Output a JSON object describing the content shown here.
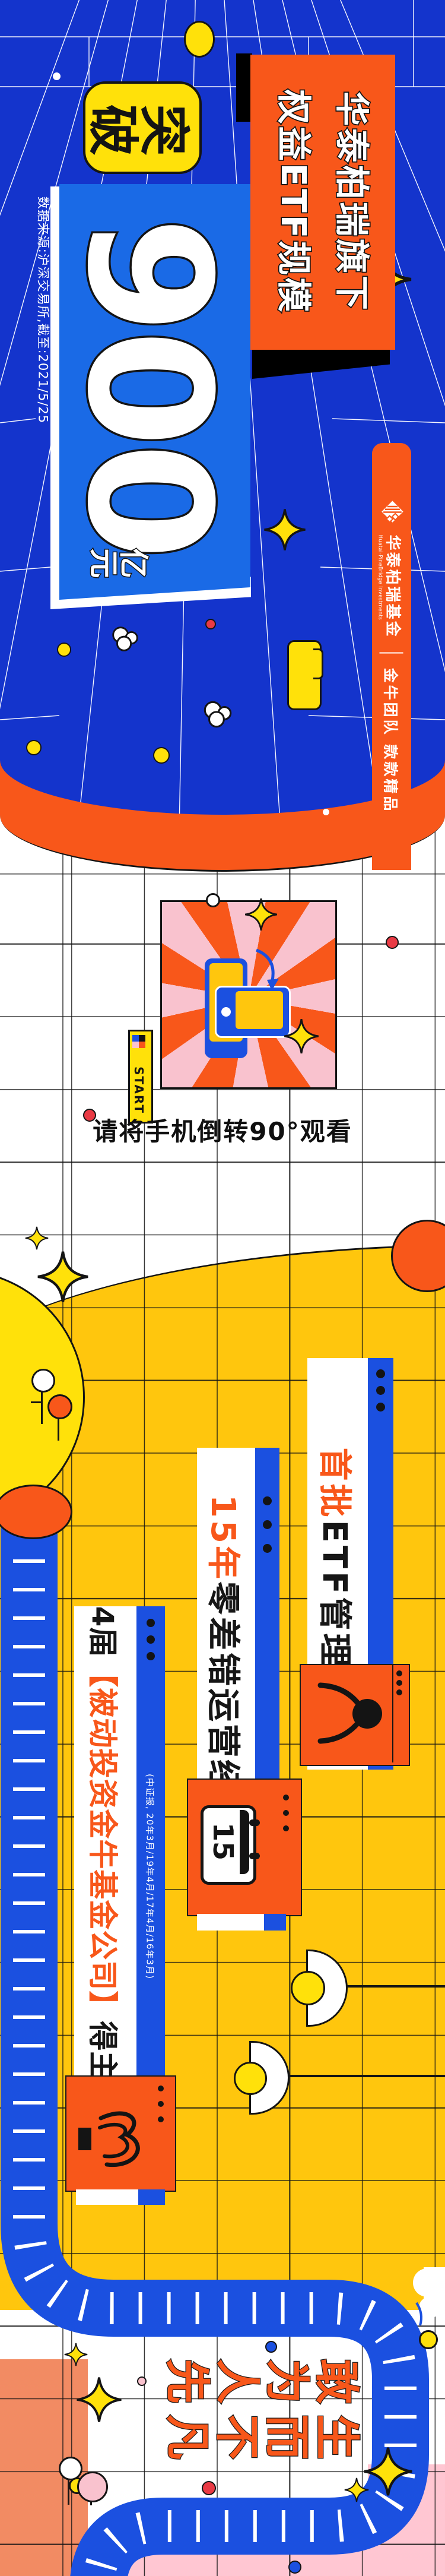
{
  "palette": {
    "bg_blue": "#1434CC",
    "panel_blue": "#1A6AE6",
    "brand_blue": "#1B50E0",
    "brand_orange": "#F8571A",
    "bright_yellow": "#FFE10A",
    "golden": "#FFC60D",
    "pink": "#F9C2CE",
    "bottom_pink": "#FFC6D2",
    "salmon": "#F28B63",
    "ink": "#141414",
    "red": "#E93A44"
  },
  "hero": {
    "badge": "突破",
    "amount": "900",
    "unit": "亿元",
    "title_line1": "华泰柏瑞旗下",
    "title_line2": "权益ETF规模",
    "source_note": "数据来源:沪深交易所,截至:2021/5/25"
  },
  "brand": {
    "logo_name": "华泰柏瑞基金",
    "logo_name_en": "Huatai-PineBridge Investments",
    "tagline": "金牛团队 款款精品"
  },
  "rotate_hint": {
    "caption": "请将手机倒转90°观看",
    "start_label": "START"
  },
  "highlights": {
    "item1": {
      "prefix": "首批",
      "rest": "ETF管理人"
    },
    "item2": {
      "prefix": "15年",
      "rest": "零差错运营经验"
    },
    "item3": {
      "pre": "4届",
      "highlight": "【被动投资金牛基金公司】",
      "suffix": "得主"
    },
    "citation": "(中证报, 20年3月/19年4月/17年4月/16年3月)",
    "calendar_day": "15"
  },
  "slogan": {
    "line1": "生而不凡",
    "line2": "敢为人先"
  },
  "icons": [
    "diamond-logo-icon",
    "sparkle-icon",
    "cloud-icon",
    "phone-portrait-icon",
    "phone-landscape-icon",
    "rotate-arrow-icon",
    "flag-icon",
    "balloon-icon",
    "calendar-icon",
    "trophy-icon",
    "lamp-icon",
    "road",
    "cup-icon"
  ]
}
